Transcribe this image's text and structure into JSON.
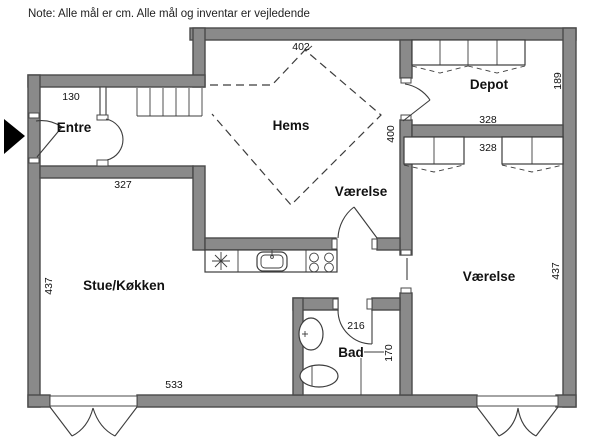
{
  "note": "Note: Alle mål er cm. Alle mål og inventar er vejledende",
  "colors": {
    "background": "#ffffff",
    "wall_fill": "#8a8a8a",
    "wall_stroke": "#4a4a4a",
    "line": "#3c3c3c",
    "entrance_arrow": "#000000",
    "text": "#111111"
  },
  "rooms": {
    "entre": {
      "label": "Entre",
      "width": "130"
    },
    "stue_kokken": {
      "label": "Stue/Køkken",
      "width_top": "327",
      "width_bottom": "533",
      "depth": "437"
    },
    "hems": {
      "label": "Hems",
      "width": "402",
      "depth": "400"
    },
    "vaerelse_mid": {
      "label": "Værelse"
    },
    "depot": {
      "label": "Depot",
      "width": "328",
      "depth": "189"
    },
    "vaerelse_right": {
      "label": "Værelse",
      "width": "328",
      "depth": "437"
    },
    "bad": {
      "label": "Bad",
      "width": "216",
      "depth": "170"
    }
  }
}
